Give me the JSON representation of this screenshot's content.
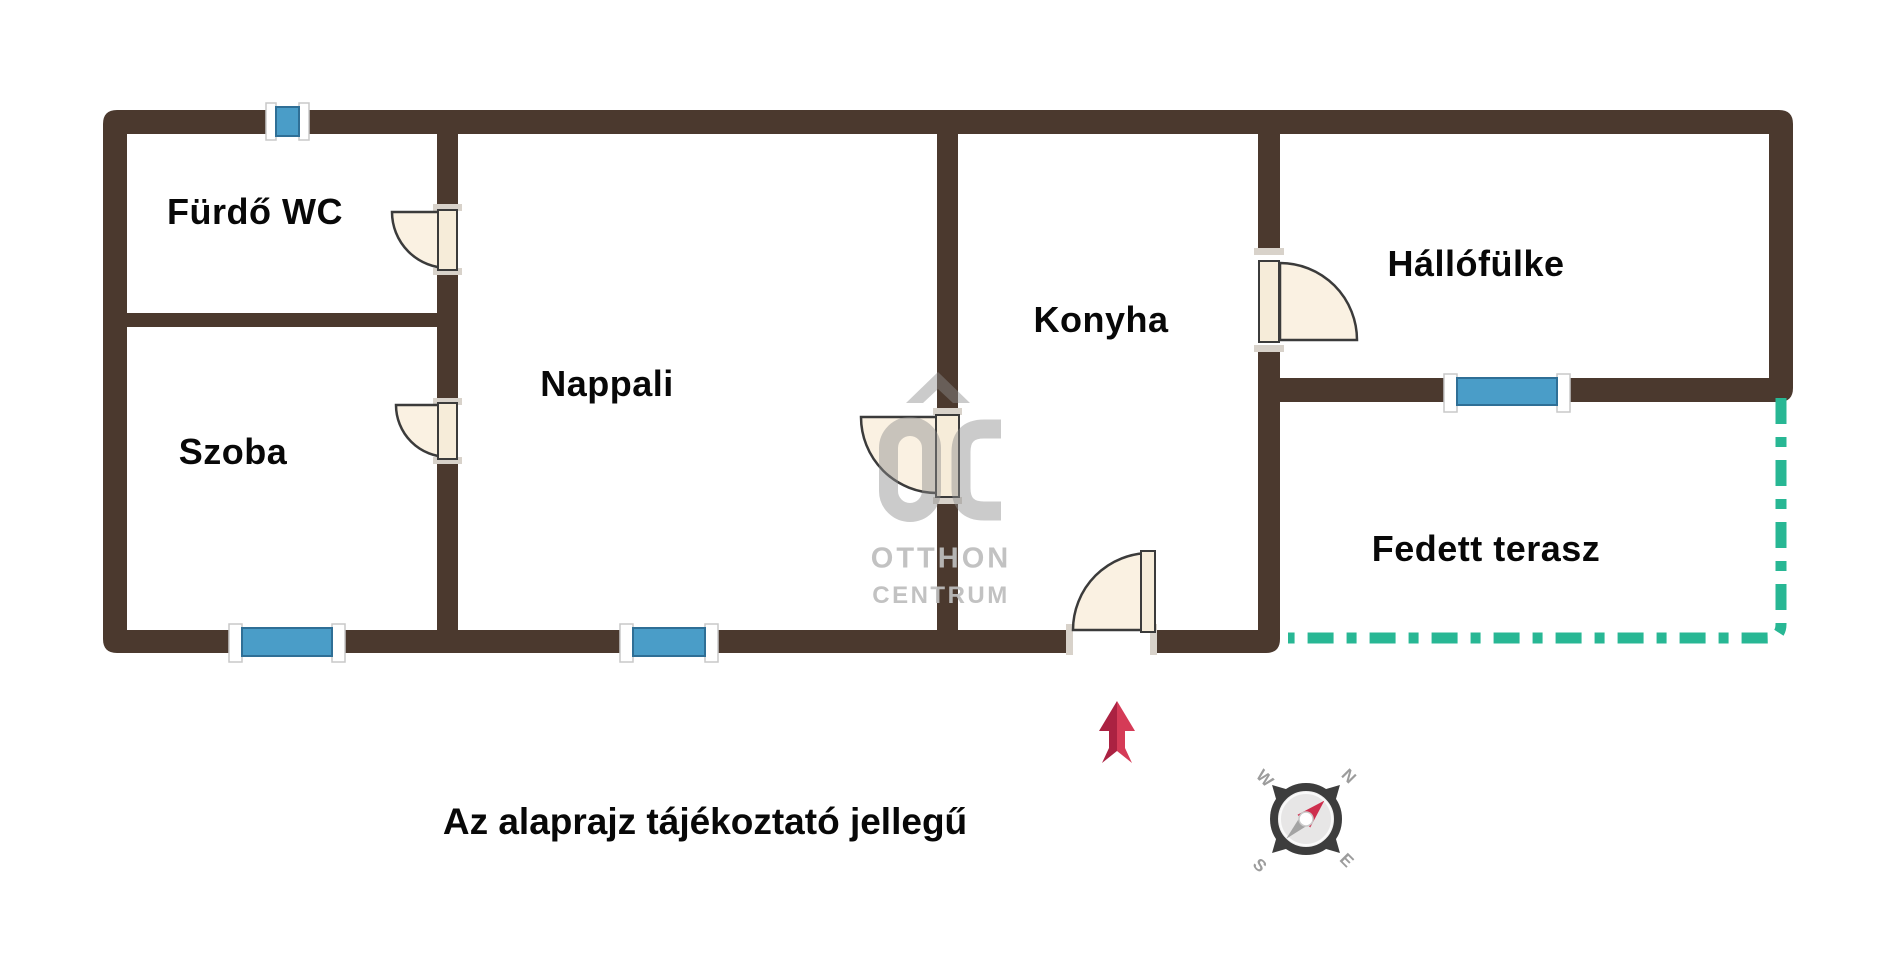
{
  "rooms": [
    {
      "label": "Fürdő WC"
    },
    {
      "label": "Szoba"
    },
    {
      "label": "Nappali"
    },
    {
      "label": "Konyha"
    },
    {
      "label": "Hállófülke"
    },
    {
      "label": "Fedett terasz"
    }
  ],
  "note": "Az alaprajz tájékoztató jellegű",
  "watermark": {
    "logo": "OC",
    "brand_line1": "OTTHON",
    "brand_line2": "CENTRUM"
  },
  "compass": {
    "north": "N",
    "east": "E",
    "south": "S",
    "west": "W"
  },
  "colors": {
    "wall": "#4b392e",
    "window": "#4a9dc8",
    "door_leaf": "#faf1e2",
    "terrace_boundary": "#28b794",
    "entrance_arrow": "#d53b57",
    "entrance_arrow_dark": "#ab2242",
    "watermark_grey": "#bfbfbf",
    "compass_ring": "#3d3d3d"
  }
}
